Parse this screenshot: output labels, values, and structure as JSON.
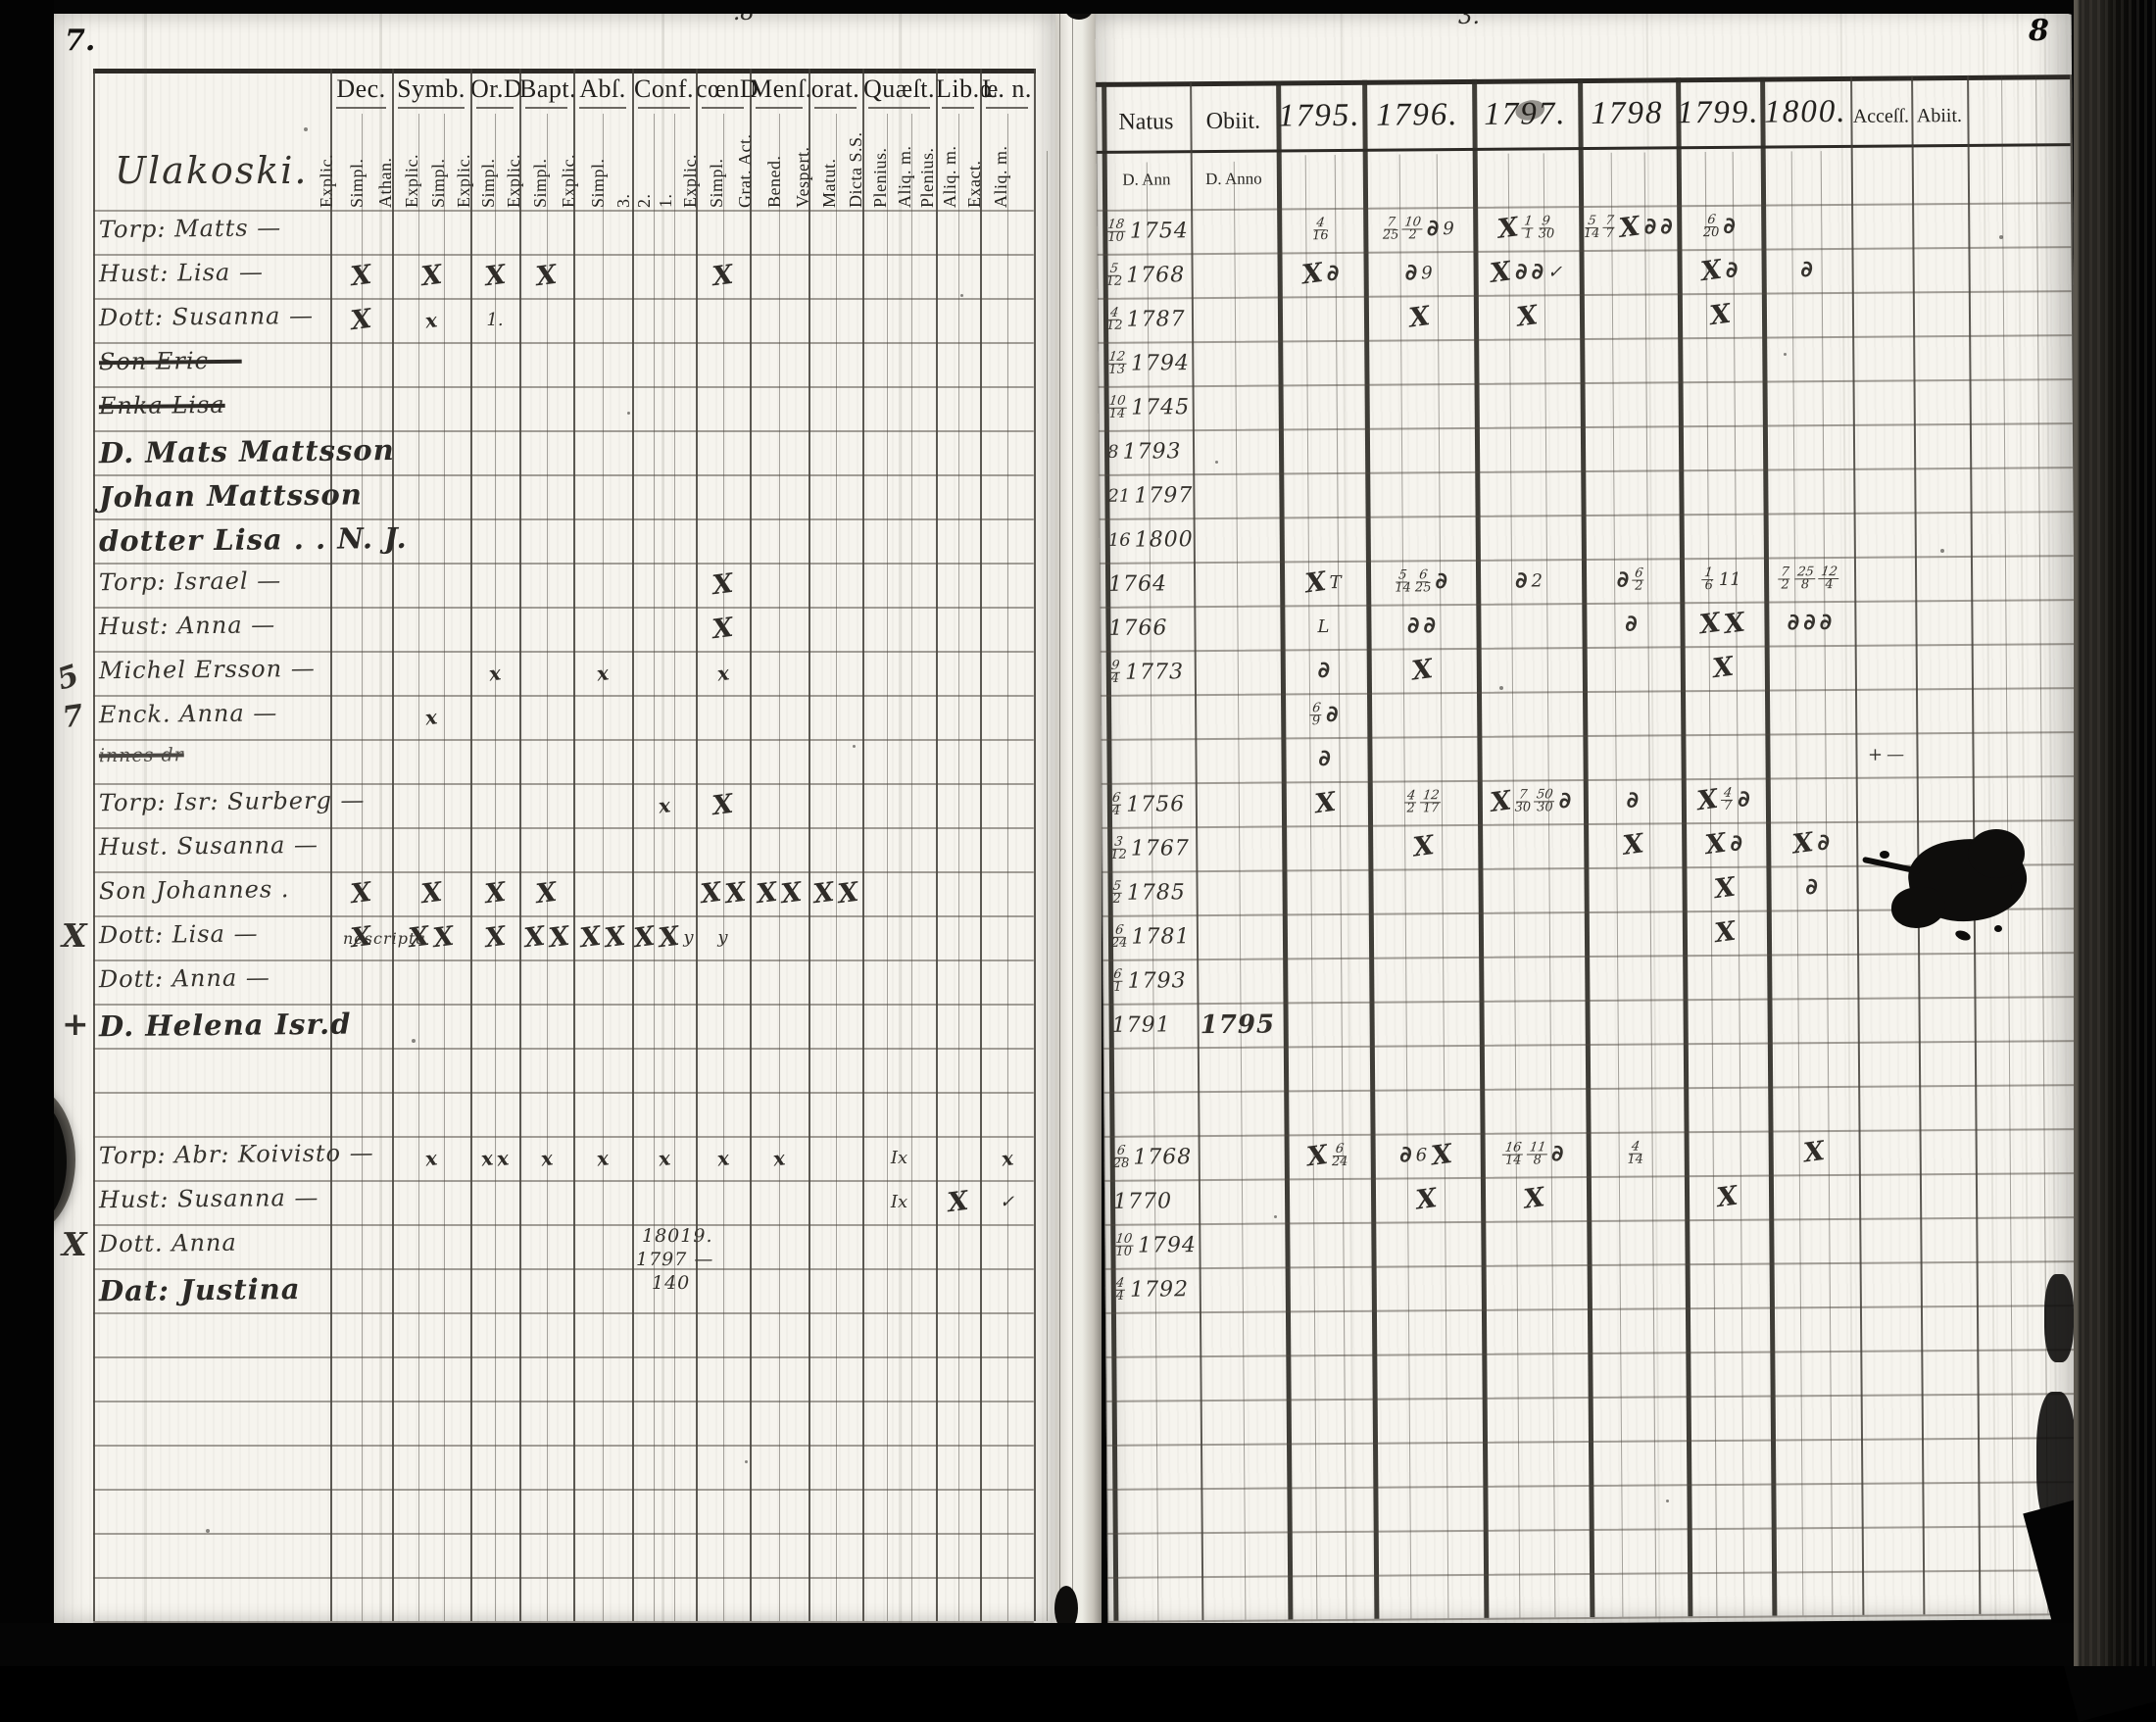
{
  "document": {
    "scan": {
      "left_page_number": "7.",
      "right_page_number": "8",
      "top_center_marks": [
        ".8",
        "3."
      ]
    },
    "left_page": {
      "heading": "Ulakoski.",
      "margin_brace": "5 7",
      "columns": [
        {
          "id": "dec",
          "label": "Dec.",
          "subs": [
            "Explic.",
            "Simpl."
          ]
        },
        {
          "id": "symb",
          "label": "Symb.",
          "subs": [
            "Athan.",
            "Explic.",
            "Simpl."
          ]
        },
        {
          "id": "ord",
          "label": "Or.D",
          "subs": [
            "Explic.",
            "Simpl."
          ]
        },
        {
          "id": "bapt",
          "label": "Bapt.",
          "subs": [
            "Explic.",
            "Simpl."
          ]
        },
        {
          "id": "abs",
          "label": "Abſ.",
          "subs": [
            "Explic.",
            "Simpl."
          ]
        },
        {
          "id": "conf",
          "label": "Conf.",
          "subs": [
            "3.",
            "2.",
            "1."
          ]
        },
        {
          "id": "coend",
          "label": "cœnD",
          "subs": [
            "Explic.",
            "Simpl."
          ]
        },
        {
          "id": "mens",
          "label": "Menſ.",
          "subs": [
            "Grat. Act.",
            "Bened."
          ]
        },
        {
          "id": "orat",
          "label": "orat.",
          "subs": [
            "Vespert.",
            "Matut."
          ]
        },
        {
          "id": "quaest",
          "label": "Quæſt.",
          "subs": [
            "Dicta S.S.",
            "Plenius.",
            "Aliq. m."
          ]
        },
        {
          "id": "liboe",
          "label": "Lib.œ",
          "subs": [
            "Plenius.",
            "Aliq. m."
          ]
        },
        {
          "id": "ln",
          "label": "L. n.",
          "subs": [
            "Exact.",
            "Aliq. m."
          ]
        }
      ],
      "rows": [
        {
          "name": "Torp: Matts —"
        },
        {
          "name": "Hust: Lisa —",
          "marks": {
            "dec": "X",
            "symb": "X",
            "ord": "X",
            "bapt": "X",
            "coend": "X"
          }
        },
        {
          "name": "Dott: Susanna —",
          "marks": {
            "dec": "X",
            "symb": "x",
            "ord": "1."
          }
        },
        {
          "name": "Son Eric —",
          "struck": true
        },
        {
          "name": "Enka Lisa",
          "struck": true
        },
        {
          "name": "D. Mats Mattsson",
          "big": true
        },
        {
          "name": "Johan Mattsson",
          "big": true
        },
        {
          "name": "dotter Lisa . . N. J.",
          "big": true
        },
        {
          "name": "Torp: Israel —",
          "marks": {
            "coend": "X"
          }
        },
        {
          "name": "Hust: Anna —",
          "marks": {
            "coend": "X"
          }
        },
        {
          "name": "Michel Ersson —",
          "marks": {
            "ord": "x",
            "abs": "x",
            "coend": "x"
          }
        },
        {
          "name": "Enck. Anna —",
          "marks": {
            "symb": "x"
          }
        },
        {
          "name": "innes dr",
          "struck": true,
          "small": true
        },
        {
          "name": "Torp: Isr: Surberg —",
          "marks": {
            "conf": "x",
            "coend": "X"
          }
        },
        {
          "name": "Hust. Susanna —"
        },
        {
          "name": "Son Johannes .",
          "marks": {
            "dec": "X",
            "symb": "X",
            "ord": "X",
            "bapt": "X",
            "coend": "X X",
            "mens": "X X",
            "orat": "X X"
          }
        },
        {
          "name": "Dott: Lisa —",
          "margin": "X",
          "note": "nescripta",
          "marks": {
            "dec": "X",
            "symb": "X X",
            "ord": "X",
            "bapt": "X X",
            "abs": "X X",
            "conf": "X X y",
            "coend": "y"
          }
        },
        {
          "name": "Dott: Anna —"
        },
        {
          "name": "D. Helena Isr.d",
          "big": true,
          "margin": "+"
        },
        {},
        {},
        {
          "name": "Torp: Abr: Koivisto —",
          "marks": {
            "symb": "x",
            "ord": "x x",
            "bapt": "x",
            "abs": "x",
            "conf": "x",
            "coend": "x",
            "mens": "x",
            "quaest": "Ix",
            "ln": "x"
          }
        },
        {
          "name": "Hust: Susanna —",
          "marks": {
            "quaest": "Ix",
            "liboe": "X",
            "ln": "✓"
          }
        },
        {
          "name": "Dott. Anna",
          "margin": "X"
        },
        {
          "name": "Dat: Justina",
          "big": true
        }
      ],
      "footnote_lines": [
        "18019.",
        "1797 —",
        "140"
      ]
    },
    "right_page": {
      "natus": {
        "label": "Natus",
        "sub": "D. Ann"
      },
      "obiit": {
        "label": "Obiit.",
        "sub": "D. Anno"
      },
      "years": [
        "1795.",
        "1796.",
        "1797.",
        "1798",
        "1799.",
        "1800."
      ],
      "access_label": "Acceſſ.",
      "abiit_label": "Abiit.",
      "rows": [
        {
          "nd": "18/10",
          "ny": "1754",
          "y95": "4/16",
          "y96": "7/25 10/2 ∂ 9",
          "y97": "X 1/1 9/30",
          "y98": "5/14 7/7 X ∂ ∂",
          "y99": "6/20 ∂"
        },
        {
          "nd": "5/12",
          "ny": "1768",
          "y95": "X ∂",
          "y96": "∂ 9",
          "y97": "X ∂ ∂ ✓",
          "y99": "X ∂",
          "y00": "∂"
        },
        {
          "nd": "4/12",
          "ny": "1787",
          "y96": "X",
          "y97": "X",
          "y99": "X"
        },
        {
          "nd": "12/13",
          "ny": "1794"
        },
        {
          "nd": "10/14",
          "ny": "1745"
        },
        {
          "nd": "8",
          "ny": "1793"
        },
        {
          "nd": "21",
          "ny": "1797"
        },
        {
          "nd": "16",
          "ny": "1800"
        },
        {
          "ny": "1764",
          "y95": "X T",
          "y96": "5/14 6/25 ∂",
          "y97": "∂ 2",
          "y98": "∂ 6/2",
          "y99": "1/6 11",
          "y00": "7/2 25/8 12/4"
        },
        {
          "ny": "1766",
          "y95": "L",
          "y96": "∂ ∂",
          "y98": "∂",
          "y99": "X X",
          "y00": "∂ ∂ ∂"
        },
        {
          "nd": "9/4",
          "ny": "1773",
          "y95": "∂",
          "y96": "X",
          "y99": "X"
        },
        {
          "y95": "6/9 ∂"
        },
        {
          "y95": "∂",
          "acc": "+ —"
        },
        {
          "nd": "6/4",
          "ny": "1756",
          "y95": "X",
          "y96": "4/2 12/17",
          "y97": "X 7/30 50/30 ∂",
          "y98": "∂",
          "y99": "X 4/7 ∂"
        },
        {
          "nd": "3/12",
          "ny": "1767",
          "y96": "X",
          "y98": "X",
          "y99": "X ∂",
          "y00": "X ∂"
        },
        {
          "nd": "5/2",
          "ny": "1785",
          "y99": "X",
          "y00": "∂"
        },
        {
          "nd": "6/24",
          "ny": "1781",
          "y99": "X"
        },
        {
          "nd": "6/1",
          "ny": "1793"
        },
        {
          "ny": "1791",
          "oy": "1795"
        },
        {},
        {},
        {
          "nd": "6/28",
          "ny": "1768",
          "y95": "X 6/24",
          "y96": "∂ 6 X",
          "y97": "16/14 11/8 ∂",
          "y98": "4/14",
          "y00": "X"
        },
        {
          "ny": "1770",
          "y96": "X",
          "y97": "X",
          "y99": "X"
        },
        {
          "nd": "10/10",
          "ny": "1794"
        },
        {
          "nd": "4/4",
          "ny": "1792"
        }
      ]
    }
  }
}
